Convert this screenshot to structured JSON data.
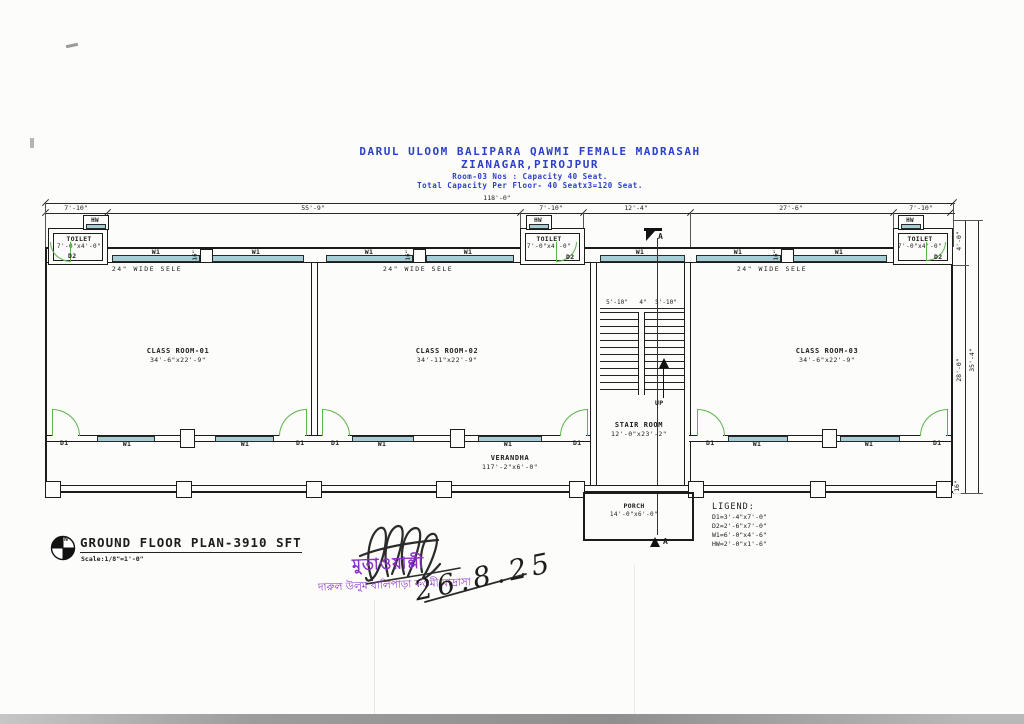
{
  "title": {
    "l1": "DARUL ULOOM BALIPARA QAWMI FEMALE MADRASAH",
    "l2": "ZIANAGAR,PIROJPUR",
    "l3": "Room-03 Nos : Capacity 40 Seat.",
    "l4": "Total Capacity Per Floor- 40 Seatx3=120 Seat."
  },
  "dims": {
    "overall": "118'-0\"",
    "seg": [
      "7'-10\"",
      "55'-9\"",
      "7'-10\"",
      "12'-4\"",
      "27'-6\"",
      "7'-10\""
    ],
    "right": {
      "toilet": "4'-0\"",
      "inner": "28'-0\"",
      "outer": "35'-4\"",
      "edge": "16\""
    },
    "stair": [
      "5'-10\"",
      "4\"",
      "5'-10\""
    ]
  },
  "labels": {
    "w1": "W1",
    "d1": "D1",
    "d2": "D2",
    "hw": "HW",
    "up": "UP",
    "shelf": "24\" WIDE SELE",
    "pier": "16\"",
    "section": "A",
    "toilet": "TOILET",
    "toilet_size": "7'-0\"x4'-0\""
  },
  "rooms": {
    "c1": {
      "name": "CLASS ROOM-01",
      "size": "34'-6\"x22'-9\""
    },
    "c2": {
      "name": "CLASS ROOM-02",
      "size": "34'-11\"x22'-9\""
    },
    "c3": {
      "name": "CLASS ROOM-03",
      "size": "34'-6\"x22'-9\""
    },
    "stair": {
      "name": "STAIR ROOM",
      "size": "12'-0\"x23'-2\""
    },
    "verandah": {
      "name": "VERANDHA",
      "size": "117'-2\"x6'-0\""
    },
    "porch": {
      "name": "PORCH",
      "size": "14'-0\"x6'-0\""
    }
  },
  "legend": {
    "title": "LIGEND:",
    "items": [
      "D1=3'-4\"x7'-0\"",
      "D2=2'-6\"x7'-0\"",
      "W1=6'-0\"x4'-6\"",
      "HW=2'-0\"x1'-6\""
    ]
  },
  "footer": {
    "plan": "GROUND FLOOR PLAN-3910 SFT",
    "scale": "Scale:1/8\"=1'-0\"",
    "north": "N"
  },
  "stamp": {
    "title": "মুতাওয়াল্লী",
    "org": "দারুল উলুম বালিপাড়া কওমী মাদ্রাসা",
    "date": "26.8.25"
  },
  "colors": {
    "blue": "#2b3fc8",
    "window": "#a6ced6",
    "door": "#5db54a",
    "stamp": "#8b2fc9",
    "line": "#1c1c1c"
  }
}
